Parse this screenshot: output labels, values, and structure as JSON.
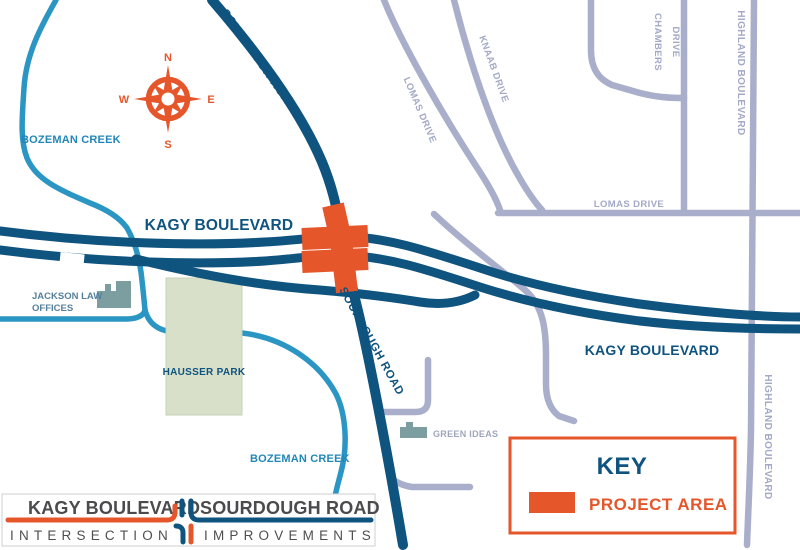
{
  "map": {
    "labels": {
      "kagy_left": "KAGY BOULEVARD",
      "kagy_right": "KAGY BOULEVARD",
      "sourdough_top": "SOURDOUGH ROAD",
      "sourdough_bottom": "SOURDOUGH ROAD",
      "bozeman_creek_top": "BOZEMAN CREEK",
      "bozeman_creek_bottom": "BOZEMAN CREEK",
      "hausser_park": "HAUSSER PARK",
      "jackson_law_line1": "JACKSON LAW",
      "jackson_law_line2": "OFFICES",
      "green_ideas": "GREEN IDEAS",
      "lomas_drive_diagonal": "LOMAS DRIVE",
      "knaab_drive": "KNAAB DRIVE",
      "chambers_drive_line1": "CHAMBERS",
      "chambers_drive_line2": "DRIVE",
      "lomas_drive_horizontal": "LOMAS DRIVE",
      "highland_blvd_top": "HIGHLAND BOULEVARD",
      "highland_blvd_bottom": "HIGHLAND BOULEVARD"
    },
    "compass": {
      "n": "N",
      "e": "E",
      "s": "S",
      "w": "W"
    }
  },
  "key": {
    "title": "KEY",
    "project_area_label": "PROJECT AREA"
  },
  "title_block": {
    "road1": "KAGY BOULEVARD",
    "road2": "SOURDOUGH ROAD",
    "sub1": "INTERSECTION",
    "sub2": "IMPROVEMENTS"
  },
  "colors": {
    "road_dark_blue": "#0F537F",
    "creek_teal": "#2B96C3",
    "road_gray": "#A9AECB",
    "accent_orange": "#E5562B",
    "park_green": "#D8E0CA",
    "building_gray": "#7C9EA0",
    "title_text_gray": "#4B4B4D"
  }
}
